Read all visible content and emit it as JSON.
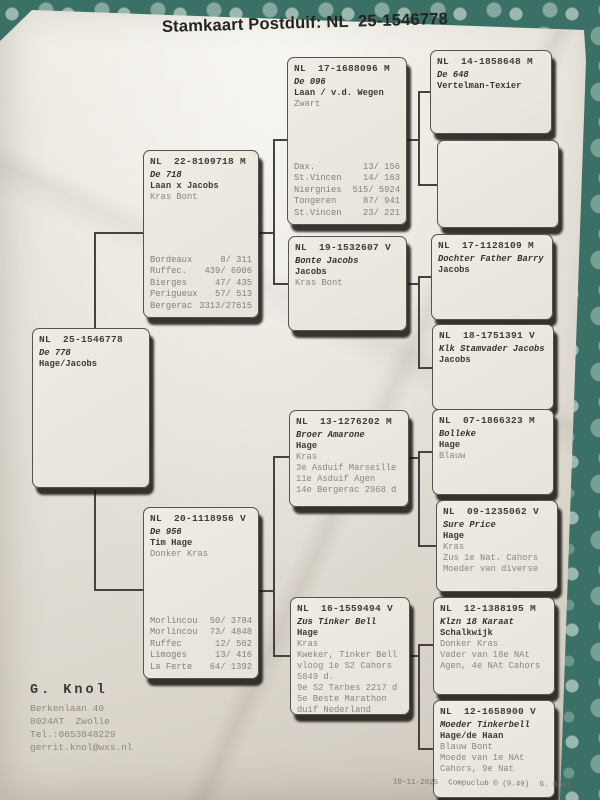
{
  "title": "Stamkaart Postduif: NL  25-1546778",
  "boxes": {
    "b25": {
      "ring": "NL  25-1546778",
      "lines": [
        "De 778",
        "Hage/Jacobs"
      ]
    },
    "b22": {
      "ring": "NL  22-8109718 M",
      "lines": [
        "De 718",
        "Laan x Jacobs",
        "Kras Bont"
      ],
      "results": [
        {
          "race": "Bordeaux",
          "score": "8/ 311"
        },
        {
          "race": "Ruffec.",
          "score": "439/ 6906"
        },
        {
          "race": "Bierges",
          "score": "47/ 435"
        },
        {
          "race": "Perigueux",
          "score": "57/ 513"
        },
        {
          "race": "Bergerac",
          "score": "3313/27615"
        }
      ]
    },
    "b20": {
      "ring": "NL  20-1118956 V",
      "lines": [
        "De 956",
        "Tim Hage",
        "Donker Kras"
      ],
      "results": [
        {
          "race": "Morlincou",
          "score": "50/ 3784"
        },
        {
          "race": "Morlincou",
          "score": "73/ 4848"
        },
        {
          "race": "Ruffec",
          "score": "12/ 562"
        },
        {
          "race": "Limoges",
          "score": "13/ 416"
        },
        {
          "race": "La Ferte",
          "score": "64/ 1392"
        }
      ]
    },
    "b17a": {
      "ring": "NL  17-1688096 M",
      "lines": [
        "De 096",
        "Laan / v.d. Wegen",
        "Zwart"
      ],
      "results": [
        {
          "race": "Dax.",
          "score": "13/ 156"
        },
        {
          "race": "St.Vincen",
          "score": "14/ 163"
        },
        {
          "race": "Niergnies",
          "score": "515/ 5924"
        },
        {
          "race": "Tongeren",
          "score": "87/ 941"
        },
        {
          "race": "St.Vincen",
          "score": "23/ 221"
        }
      ]
    },
    "b19": {
      "ring": "NL  19-1532607 V",
      "lines": [
        "Bonte Jacobs",
        "Jacobs",
        "Kras Bont"
      ]
    },
    "b13": {
      "ring": "NL  13-1276202 M",
      "lines": [
        "Broer Amarone",
        "Hage",
        "Kras",
        "3e Asduif Marseille",
        "11e Asduif Agen",
        "14e Bergerac 2968 d"
      ]
    },
    "b16": {
      "ring": "NL  16-1559494 V",
      "lines": [
        "Zus Tinker Bell",
        "Hage",
        "Kras",
        "Kweker, Tinker Bell",
        "vloog 1e S2 Cahors",
        "5849 d.",
        "9e S2 Tarbes 2217 d",
        "5e Beste Marathon",
        "duif Nederland"
      ]
    },
    "b14": {
      "ring": "NL  14-1858648 M",
      "lines": [
        "De 648",
        "Vertelman-Texier"
      ]
    },
    "b17b": {
      "ring": "NL  17-1128109 M",
      "lines": [
        "Dochter Father Barry",
        "Jacobs"
      ]
    },
    "b18": {
      "ring": "NL  18-1751391 V",
      "lines": [
        "Klk Stamvader Jacobs",
        "Jacobs"
      ]
    },
    "b07": {
      "ring": "NL  07-1866323 M",
      "lines": [
        "Bolleke",
        "Hage",
        "Blauw"
      ]
    },
    "b09": {
      "ring": "NL  09-1235062 V",
      "lines": [
        "Sure Price",
        "Hage",
        "Kras",
        "Zus 1e Nat. Cahors",
        "Moeder van diverse"
      ]
    },
    "b12a": {
      "ring": "NL  12-1388195 M",
      "lines": [
        "Klzn 18 Karaat",
        "Schalkwijk",
        "Donker Kras",
        "Vader van 18e NAt",
        "Agen, 4e NAt Cahors"
      ]
    },
    "b12b": {
      "ring": "NL  12-1658900 V",
      "lines": [
        "Moeder Tinkerbell",
        "Hage/de Haan",
        "Blauw Bont",
        "Moede van 1e NAt",
        "Cahors, 9e Nat"
      ]
    }
  },
  "owner": {
    "name": "G. Knol",
    "lines": [
      "Berkenlaan 40",
      "8024AT  Zwolle",
      "Tel.:0653848229",
      "gerrit.knol@wxs.nl"
    ]
  },
  "footer": {
    "date": "10-11-2025",
    "program": "Compuclub © (9.49)",
    "author": "G. Knol"
  }
}
